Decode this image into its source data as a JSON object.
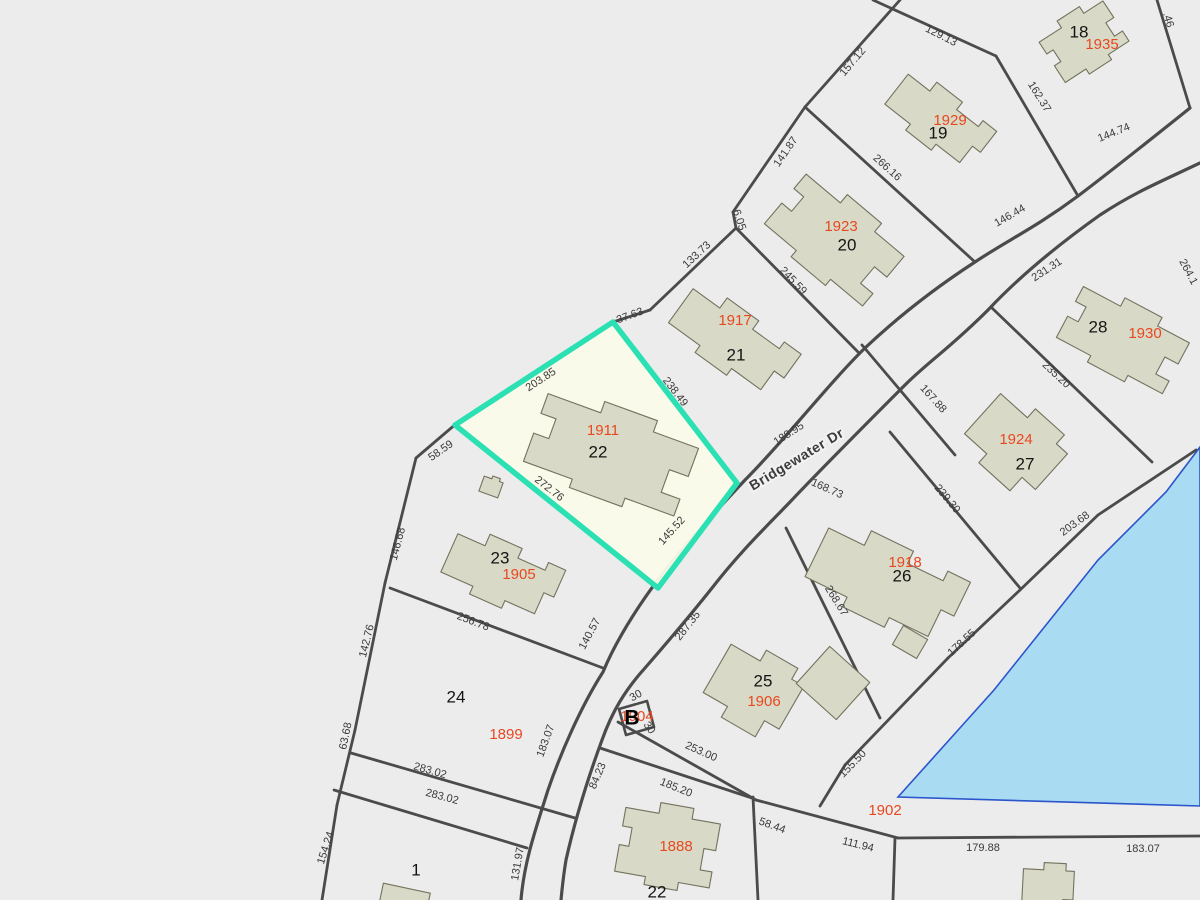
{
  "map": {
    "width": 1200,
    "height": 900,
    "colors": {
      "background": "#ececec",
      "parcel_line": "#4b4b4b",
      "building_fill": "#d9d9c7",
      "building_stroke": "#72725e",
      "highlight_stroke": "#2be0b3",
      "highlight_fill": "#fafbe9",
      "pond_fill": "#a9dbf2",
      "pond_stroke": "#2b55cc",
      "dim_text": "#3a3a3a",
      "lot_text": "#141414",
      "house_text": "#e8481f"
    },
    "road_label": {
      "text": "Bridgewater Dr",
      "x": 797,
      "y": 460,
      "rot": -31
    },
    "block_marker": {
      "text": "B",
      "x": 632,
      "y": 719,
      "house": "1904",
      "hx": 637,
      "hy": 717
    },
    "selected_parcel": {
      "lot": "22",
      "points": [
        [
          613,
          322
        ],
        [
          737,
          483
        ],
        [
          658,
          588
        ],
        [
          455,
          425
        ]
      ]
    },
    "pond": {
      "points": [
        [
          1200,
          447
        ],
        [
          1166,
          492
        ],
        [
          1098,
          560
        ],
        [
          994,
          690
        ],
        [
          898,
          797
        ],
        [
          1200,
          806
        ]
      ]
    },
    "b_box": {
      "points": [
        [
          619,
          709
        ],
        [
          647,
          701
        ],
        [
          654,
          727
        ],
        [
          626,
          735
        ]
      ]
    },
    "road_edges": [
      "M1190,108 C1150,140 1110,172 1078,196 C1035,228 1008,240 975,262 C935,288 900,315 865,348 C830,382 785,440 745,480 C706,522 670,560 640,605 C620,635 610,655 603,672 C580,708 560,755 548,790 C536,828 524,862 521,900",
      "M1200,163 C1160,182 1135,192 1100,215 C1055,247 1018,278 988,310 C950,348 928,362 905,385 C868,422 825,465 790,502 C765,528 740,552 712,588 C685,622 665,645 645,668 C625,690 612,712 602,740 C588,778 575,820 566,860 C563,878 562,890 561,900"
    ],
    "parcel_lines": [
      [
        873,
        0,
        996,
        56
      ],
      [
        996,
        56,
        1078,
        196
      ],
      [
        900,
        0,
        805,
        107
      ],
      [
        805,
        107,
        733,
        212
      ],
      [
        805,
        107,
        975,
        262
      ],
      [
        733,
        212,
        736,
        228
      ],
      [
        736,
        228,
        650,
        310
      ],
      [
        650,
        310,
        613,
        322
      ],
      [
        1157,
        0,
        1190,
        108
      ],
      [
        736,
        228,
        858,
        352
      ],
      [
        862,
        345,
        955,
        455
      ],
      [
        890,
        432,
        1020,
        588
      ],
      [
        992,
        308,
        1152,
        462
      ],
      [
        786,
        528,
        880,
        718
      ],
      [
        1196,
        450,
        1098,
        515
      ],
      [
        1098,
        515,
        1020,
        590
      ],
      [
        1020,
        590,
        948,
        658
      ],
      [
        948,
        658,
        845,
        765
      ],
      [
        845,
        765,
        820,
        806
      ],
      [
        618,
        722,
        756,
        800
      ],
      [
        756,
        800,
        898,
        838
      ],
      [
        898,
        838,
        1200,
        836
      ],
      [
        895,
        838,
        893,
        900
      ],
      [
        753,
        797,
        758,
        900
      ],
      [
        600,
        748,
        752,
        798
      ],
      [
        390,
        588,
        603,
        668
      ],
      [
        457,
        423,
        416,
        458
      ],
      [
        416,
        458,
        385,
        583
      ],
      [
        385,
        583,
        355,
        730
      ],
      [
        355,
        730,
        337,
        805
      ],
      [
        337,
        805,
        322,
        900
      ],
      [
        351,
        753,
        575,
        818
      ],
      [
        334,
        790,
        527,
        848
      ]
    ],
    "dimensions": [
      {
        "t": "157.12",
        "x": 853,
        "y": 62,
        "r": -50
      },
      {
        "t": "129.13",
        "x": 941,
        "y": 36,
        "r": 27
      },
      {
        "t": ".46",
        "x": 1168,
        "y": 20,
        "r": 73
      },
      {
        "t": "162.37",
        "x": 1039,
        "y": 97,
        "r": 58
      },
      {
        "t": "144.74",
        "x": 1114,
        "y": 133,
        "r": -22
      },
      {
        "t": "146.44",
        "x": 1010,
        "y": 216,
        "r": -30
      },
      {
        "t": "231.31",
        "x": 1047,
        "y": 270,
        "r": -33
      },
      {
        "t": "264.1",
        "x": 1188,
        "y": 272,
        "r": 62
      },
      {
        "t": "141.87",
        "x": 786,
        "y": 152,
        "r": -55
      },
      {
        "t": "266.16",
        "x": 887,
        "y": 168,
        "r": 42
      },
      {
        "t": "6.05",
        "x": 739,
        "y": 220,
        "r": 72
      },
      {
        "t": "133.73",
        "x": 697,
        "y": 255,
        "r": -43
      },
      {
        "t": "37.63",
        "x": 630,
        "y": 316,
        "r": -20
      },
      {
        "t": "245.59",
        "x": 793,
        "y": 281,
        "r": 46
      },
      {
        "t": "203.85",
        "x": 541,
        "y": 380,
        "r": -33
      },
      {
        "t": "238.49",
        "x": 675,
        "y": 392,
        "r": 52
      },
      {
        "t": "188.95",
        "x": 789,
        "y": 434,
        "r": -33
      },
      {
        "t": "167.88",
        "x": 933,
        "y": 399,
        "r": 48
      },
      {
        "t": "235.20",
        "x": 1056,
        "y": 375,
        "r": 43
      },
      {
        "t": "239.30",
        "x": 947,
        "y": 499,
        "r": 50
      },
      {
        "t": "203.68",
        "x": 1075,
        "y": 524,
        "r": -36
      },
      {
        "t": "178.55",
        "x": 962,
        "y": 643,
        "r": -43
      },
      {
        "t": "155.50",
        "x": 853,
        "y": 764,
        "r": -46
      },
      {
        "t": "168.73",
        "x": 827,
        "y": 489,
        "r": 24
      },
      {
        "t": "268.67",
        "x": 836,
        "y": 601,
        "r": 58
      },
      {
        "t": "287.35",
        "x": 688,
        "y": 626,
        "r": -52
      },
      {
        "t": "58.59",
        "x": 441,
        "y": 451,
        "r": -35
      },
      {
        "t": "146.68",
        "x": 398,
        "y": 544,
        "r": -75
      },
      {
        "t": "272.76",
        "x": 549,
        "y": 489,
        "r": 38
      },
      {
        "t": "145.52",
        "x": 672,
        "y": 531,
        "r": -48
      },
      {
        "t": "142.76",
        "x": 367,
        "y": 641,
        "r": -76
      },
      {
        "t": "256.78",
        "x": 473,
        "y": 622,
        "r": 21
      },
      {
        "t": "140.57",
        "x": 590,
        "y": 634,
        "r": -62
      },
      {
        "t": "63.68",
        "x": 346,
        "y": 736,
        "r": -78
      },
      {
        "t": "183.07",
        "x": 546,
        "y": 741,
        "r": -70
      },
      {
        "t": "283.02",
        "x": 430,
        "y": 771,
        "r": 16
      },
      {
        "t": "283.02",
        "x": 442,
        "y": 797,
        "r": 15
      },
      {
        "t": "154.24",
        "x": 326,
        "y": 848,
        "r": -72
      },
      {
        "t": "131.97",
        "x": 518,
        "y": 864,
        "r": -80
      },
      {
        "t": "84.23",
        "x": 598,
        "y": 776,
        "r": -67
      },
      {
        "t": "30",
        "x": 636,
        "y": 696,
        "r": -30
      },
      {
        "t": "30",
        "x": 649,
        "y": 728,
        "r": 55
      },
      {
        "t": "253.00",
        "x": 701,
        "y": 752,
        "r": 24
      },
      {
        "t": "185.20",
        "x": 676,
        "y": 788,
        "r": 22
      },
      {
        "t": "58.44",
        "x": 772,
        "y": 826,
        "r": 20
      },
      {
        "t": "111.94",
        "x": 858,
        "y": 845,
        "r": 14
      },
      {
        "t": "179.88",
        "x": 983,
        "y": 848,
        "r": 0
      },
      {
        "t": "183.07",
        "x": 1143,
        "y": 849,
        "r": 0
      }
    ],
    "lot_numbers": [
      {
        "t": "18",
        "x": 1079,
        "y": 33
      },
      {
        "t": "19",
        "x": 938,
        "y": 134
      },
      {
        "t": "20",
        "x": 847,
        "y": 246
      },
      {
        "t": "21",
        "x": 736,
        "y": 356
      },
      {
        "t": "22",
        "x": 598,
        "y": 453
      },
      {
        "t": "23",
        "x": 500,
        "y": 559
      },
      {
        "t": "24",
        "x": 456,
        "y": 698
      },
      {
        "t": "25",
        "x": 763,
        "y": 682
      },
      {
        "t": "26",
        "x": 902,
        "y": 577
      },
      {
        "t": "27",
        "x": 1025,
        "y": 465
      },
      {
        "t": "28",
        "x": 1098,
        "y": 328
      },
      {
        "t": "1",
        "x": 416,
        "y": 871
      },
      {
        "t": "22",
        "x": 657,
        "y": 893
      }
    ],
    "house_numbers": [
      {
        "t": "1935",
        "x": 1102,
        "y": 45
      },
      {
        "t": "1929",
        "x": 950,
        "y": 121
      },
      {
        "t": "1923",
        "x": 841,
        "y": 227
      },
      {
        "t": "1917",
        "x": 735,
        "y": 321
      },
      {
        "t": "1911",
        "x": 603,
        "y": 431
      },
      {
        "t": "1905",
        "x": 519,
        "y": 575
      },
      {
        "t": "1899",
        "x": 506,
        "y": 735
      },
      {
        "t": "1906",
        "x": 764,
        "y": 702
      },
      {
        "t": "1918",
        "x": 905,
        "y": 563
      },
      {
        "t": "1924",
        "x": 1016,
        "y": 440
      },
      {
        "t": "1930",
        "x": 1145,
        "y": 334
      },
      {
        "t": "1888",
        "x": 676,
        "y": 847
      },
      {
        "t": "1902",
        "x": 885,
        "y": 811
      }
    ],
    "footprint_shapes": {
      "P1": [
        [
          -40,
          -22
        ],
        [
          -12,
          -22
        ],
        [
          -12,
          -30
        ],
        [
          16,
          -30
        ],
        [
          16,
          -22
        ],
        [
          40,
          -22
        ],
        [
          40,
          -2
        ],
        [
          30,
          -2
        ],
        [
          30,
          14
        ],
        [
          40,
          14
        ],
        [
          40,
          26
        ],
        [
          14,
          26
        ],
        [
          14,
          32
        ],
        [
          -14,
          32
        ],
        [
          -14,
          26
        ],
        [
          -40,
          26
        ],
        [
          -40,
          6
        ],
        [
          -32,
          6
        ],
        [
          -32,
          -8
        ],
        [
          -40,
          -8
        ]
      ],
      "P2": [
        [
          -42,
          -18
        ],
        [
          -20,
          -18
        ],
        [
          -20,
          -30
        ],
        [
          6,
          -30
        ],
        [
          6,
          -20
        ],
        [
          28,
          -20
        ],
        [
          28,
          -28
        ],
        [
          42,
          -28
        ],
        [
          42,
          0
        ],
        [
          34,
          0
        ],
        [
          34,
          22
        ],
        [
          10,
          22
        ],
        [
          10,
          30
        ],
        [
          -16,
          30
        ],
        [
          -16,
          22
        ],
        [
          -42,
          22
        ]
      ],
      "P3": [
        [
          -30,
          -20
        ],
        [
          -6,
          -20
        ],
        [
          -6,
          -28
        ],
        [
          20,
          -28
        ],
        [
          20,
          -20
        ],
        [
          30,
          -20
        ],
        [
          30,
          12
        ],
        [
          18,
          12
        ],
        [
          18,
          24
        ],
        [
          -10,
          24
        ],
        [
          -10,
          16
        ],
        [
          -30,
          16
        ]
      ],
      "R1": [
        [
          -27,
          -25
        ],
        [
          27,
          -25
        ],
        [
          27,
          25
        ],
        [
          -27,
          25
        ]
      ],
      "R2": [
        [
          -14,
          -11
        ],
        [
          14,
          -11
        ],
        [
          14,
          11
        ],
        [
          -14,
          11
        ]
      ],
      "R3": [
        [
          -24,
          -9
        ],
        [
          24,
          -9
        ],
        [
          24,
          9
        ],
        [
          -24,
          9
        ]
      ],
      "S1": [
        [
          -10,
          -8
        ],
        [
          -2,
          -8
        ],
        [
          -2,
          -11
        ],
        [
          6,
          -11
        ],
        [
          6,
          -8
        ],
        [
          10,
          -8
        ],
        [
          10,
          8
        ],
        [
          -10,
          8
        ]
      ]
    },
    "buildings": [
      {
        "name": "1935",
        "shape": "P1",
        "cx": 1083,
        "cy": 40,
        "rot": -33,
        "sx": 0.95,
        "sy": 1.0
      },
      {
        "name": "1929",
        "shape": "P2",
        "cx": 939,
        "cy": 120,
        "rot": 38,
        "sx": 1.25,
        "sy": 0.95
      },
      {
        "name": "1923",
        "shape": "P1",
        "cx": 836,
        "cy": 238,
        "rot": 40,
        "sx": 1.6,
        "sy": 1.35
      },
      {
        "name": "1917",
        "shape": "P2",
        "cx": 733,
        "cy": 341,
        "rot": 36,
        "sx": 1.5,
        "sy": 1.05
      },
      {
        "name": "1911",
        "shape": "P1",
        "cx": 612,
        "cy": 452,
        "rot": 20,
        "sx": 2.0,
        "sy": 1.5
      },
      {
        "name": "1905",
        "shape": "P2",
        "cx": 502,
        "cy": 574,
        "rot": 24,
        "sx": 1.35,
        "sy": 1.05
      },
      {
        "name": "1918",
        "shape": "P2",
        "cx": 886,
        "cy": 583,
        "rot": 26,
        "sx": 1.8,
        "sy": 1.35
      },
      {
        "name": "1924",
        "shape": "P3",
        "cx": 1014,
        "cy": 446,
        "rot": 42,
        "sx": 1.5,
        "sy": 1.5
      },
      {
        "name": "1930",
        "shape": "P1",
        "cx": 1124,
        "cy": 338,
        "rot": 28,
        "sx": 1.5,
        "sy": 1.2
      },
      {
        "name": "1906",
        "shape": "P3",
        "cx": 752,
        "cy": 692,
        "rot": 30,
        "sx": 1.4,
        "sy": 1.55
      },
      {
        "name": "1888",
        "shape": "P1",
        "cx": 668,
        "cy": 845,
        "rot": 10,
        "sx": 1.2,
        "sy": 1.35
      },
      {
        "name": "barn-25",
        "shape": "R1",
        "cx": 833,
        "cy": 683,
        "rot": 42,
        "sx": 1,
        "sy": 1
      },
      {
        "name": "shed-23",
        "shape": "S1",
        "cx": 491,
        "cy": 487,
        "rot": 20,
        "sx": 1,
        "sy": 1
      },
      {
        "name": "shed-26",
        "shape": "R2",
        "cx": 910,
        "cy": 642,
        "rot": 30,
        "sx": 1,
        "sy": 1
      },
      {
        "name": "shed-lot-1",
        "shape": "R3",
        "cx": 405,
        "cy": 897,
        "rot": 12,
        "sx": 1,
        "sy": 1
      },
      {
        "name": "1902-building",
        "shape": "P3",
        "cx": 1048,
        "cy": 888,
        "rot": 3,
        "sx": 0.85,
        "sy": 0.9
      }
    ]
  }
}
